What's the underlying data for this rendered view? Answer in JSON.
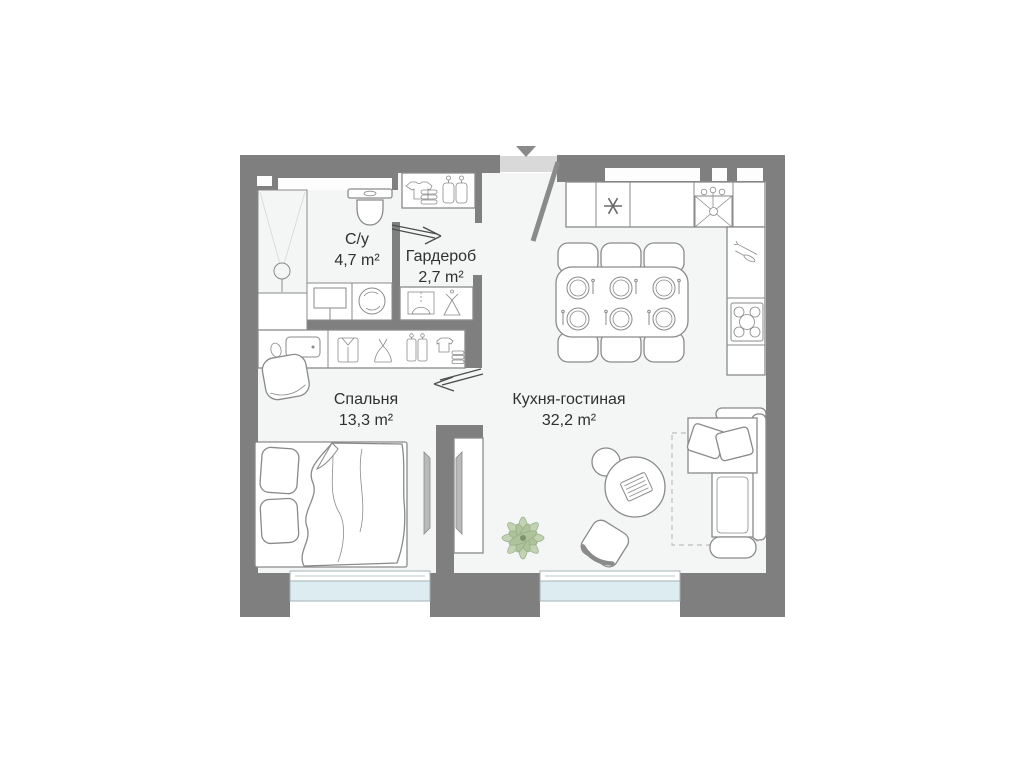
{
  "title": "apartment-floor-plan",
  "rooms": [
    {
      "id": "bathroom",
      "name": "С/у",
      "area": "4,7 m²"
    },
    {
      "id": "wardrobe",
      "name": "Гардероб",
      "area": "2,7 m²"
    },
    {
      "id": "bedroom",
      "name": "Спальня",
      "area": "13,3 m²"
    },
    {
      "id": "kitchen_living",
      "name": "Кухня-гостиная",
      "area": "32,2 m²"
    }
  ],
  "colors": {
    "wall": "#7f7f7f",
    "floor": "#f4f5f5",
    "outline": "#8a8a8a",
    "glass": "#ddecf1",
    "glassframe": "#a4b2b6",
    "leaf": "#c3d2b2",
    "leafdark": "#aec29c",
    "leafstroke": "#93ab85",
    "text": "#303030",
    "door": "#d9d9d9",
    "arrow": "#4f4f4f",
    "tvfill": "#b9b9b9"
  },
  "icons": [
    "entrance-direction-arrow",
    "entrance-door-leaf",
    "shower",
    "shower-drain",
    "toilet",
    "washbasin-cabinet",
    "washing-machine",
    "sliding-door-arrow",
    "wardrobe-cabinet",
    "folded-clothes",
    "garment-bags",
    "dress-on-hanger",
    "shirt",
    "dress",
    "baby-clothes",
    "dressing-table",
    "mirror",
    "stool",
    "double-bed",
    "pillow",
    "blanket",
    "tv",
    "tv-cabinet",
    "kitchen-counter",
    "dishwasher-asterisk",
    "kitchen-sink",
    "faucet",
    "hob-burners",
    "cutlery",
    "dining-table",
    "dining-chair",
    "place-setting",
    "round-table",
    "side-table",
    "laptop",
    "armchair",
    "plant",
    "sofa",
    "sofa-cushion",
    "rug",
    "window"
  ]
}
